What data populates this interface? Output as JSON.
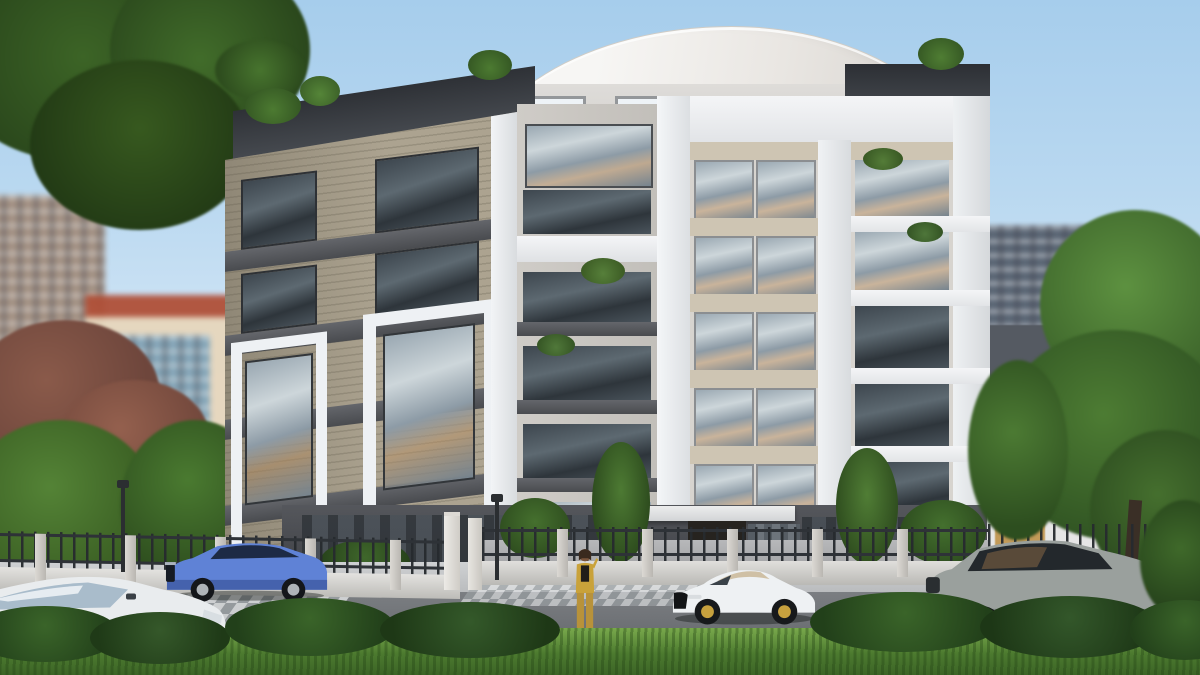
{
  "scene": {
    "category": "architectural-exterior-render",
    "description": "Sunny photorealistic rendering of a modern six-storey apartment building with a curved white roof, glass balconies, beige lap-siding corner facade, gated iron fence, parked cars and a pedestrian on the street",
    "sky": {
      "top": "#a6cdec",
      "horizon": "#f2f7fc"
    }
  },
  "building": {
    "name": "main-apartment-building",
    "storeys_visible": 6,
    "roof_style": "curved arch",
    "entrance_sign": {
      "text": "27",
      "text_color": "#c9a24a",
      "panel_color": "#26231f"
    },
    "palette": {
      "white_frames": "#eef1f4",
      "beige_siding": "#aca390",
      "dark_bands": "#54565b",
      "window_glass": "#93a3ae",
      "ground_floor": "#45474c",
      "spandrel_beige": "#cec5b3"
    },
    "features": [
      "glass balconies with plants",
      "white portal frames",
      "rooftop terrace plants",
      "white entrance canopy"
    ]
  },
  "neighborhood": {
    "left_background": [
      "blurred beige mid-rise",
      "house with red tiled roof",
      "blue glass building"
    ],
    "right_background": [
      "grey high-rise tower",
      "white low-rise with dark parapet and tan accent"
    ]
  },
  "street": {
    "fence": "low white wall with dark iron railings and concrete pillars",
    "gate_pillars": 2,
    "crosswalk": "white checkered paving",
    "lamp_posts": 2,
    "sidewalk_color": "#c2c4c6",
    "road_color": "#73767a"
  },
  "vehicles": [
    {
      "name": "white-crossover",
      "color": "#e9ecee",
      "position": "foreground left, cropped by frame"
    },
    {
      "name": "blue-suv",
      "color": "#5f82d6",
      "position": "parked at left curb"
    },
    {
      "name": "white-convertible",
      "color": "#eef0f2",
      "position": "inside courtyard behind fence"
    },
    {
      "name": "white-sports-car",
      "roof_color": "#cfc0a5",
      "color": "#eef1f3",
      "position": "driving past entrance"
    },
    {
      "name": "grey-suv",
      "color": "#9aa09d",
      "position": "parked at right curb"
    }
  ],
  "people": [
    {
      "name": "woman-in-yellow-suit",
      "outfit_color": "#c9a23a",
      "pose": "standing on sidewalk holding phone to ear"
    }
  ],
  "vegetation": {
    "foreground": [
      "grass strip",
      "box hedges"
    ],
    "left": [
      "dark green tree canopy",
      "red-leaf tree"
    ],
    "right": [
      "large green trees over neighbouring house"
    ],
    "courtyard": [
      "slim trees flanking entrance",
      "shrubs along fence"
    ]
  }
}
